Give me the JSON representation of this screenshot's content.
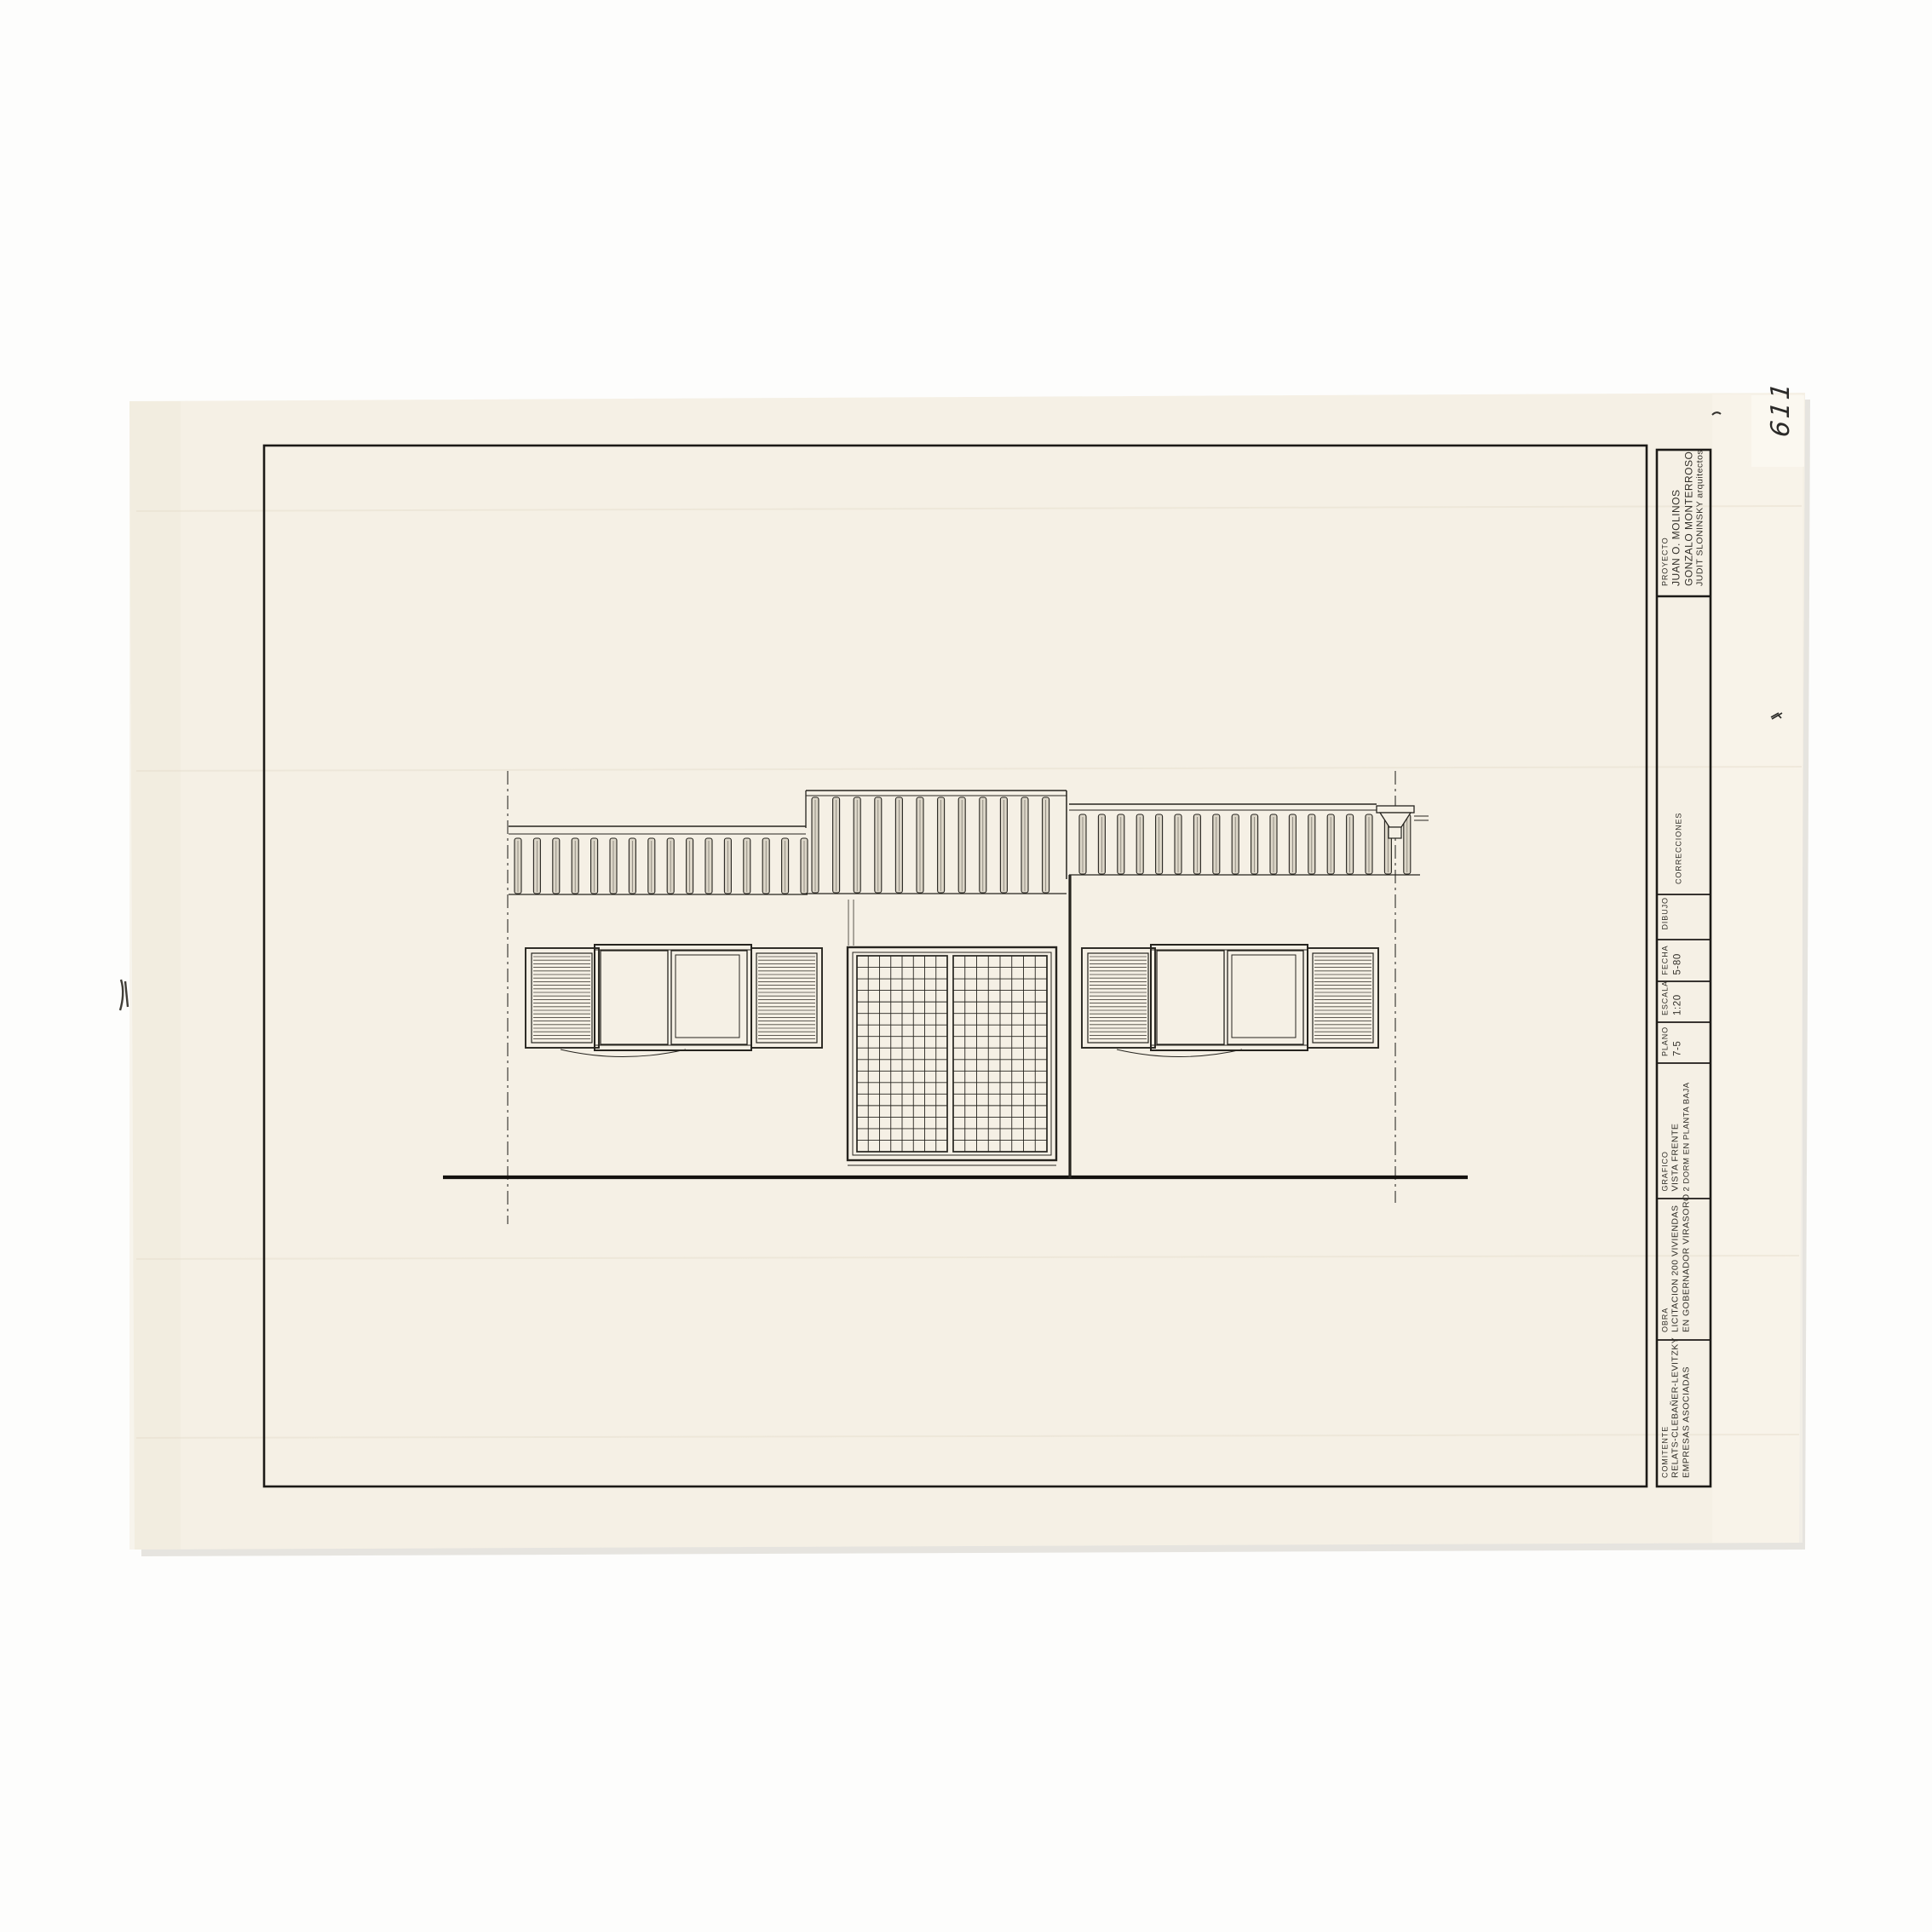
{
  "sheet": {
    "handwritten_number": "611",
    "title_block": {
      "proyecto": {
        "label": "PROYECTO",
        "lines": [
          "JUAN O. MOLINOS",
          "GONZALO MONTERROSO",
          "JUDIT SLONINSKY arquitectos"
        ]
      },
      "correcciones": {
        "label": "CORRECCIONES"
      },
      "dibujo": {
        "label": "DIBUJO"
      },
      "fecha": {
        "label": "FECHA",
        "value": "5-80"
      },
      "escala": {
        "label": "ESCALA",
        "value": "1:20"
      },
      "plano": {
        "label": "PLANO",
        "value": "7-5"
      },
      "grafico": {
        "label": "GRAFICO",
        "lines": [
          "VISTA FRENTE",
          "2 DORM EN PLANTA BAJA"
        ]
      },
      "obra": {
        "label": "OBRA",
        "lines": [
          "LICITACION 200 VIVIENDAS",
          "EN GOBERNADOR VIRASORO"
        ]
      },
      "comitente": {
        "label": "COMITENTE",
        "lines": [
          "RELATS-CLEBAÑER-LEVITZKY",
          "EMPRESAS ASOCIADAS"
        ]
      }
    },
    "colors": {
      "paper": "#f5f0e5",
      "ink": "#26241f",
      "background": "#ffffff"
    }
  }
}
